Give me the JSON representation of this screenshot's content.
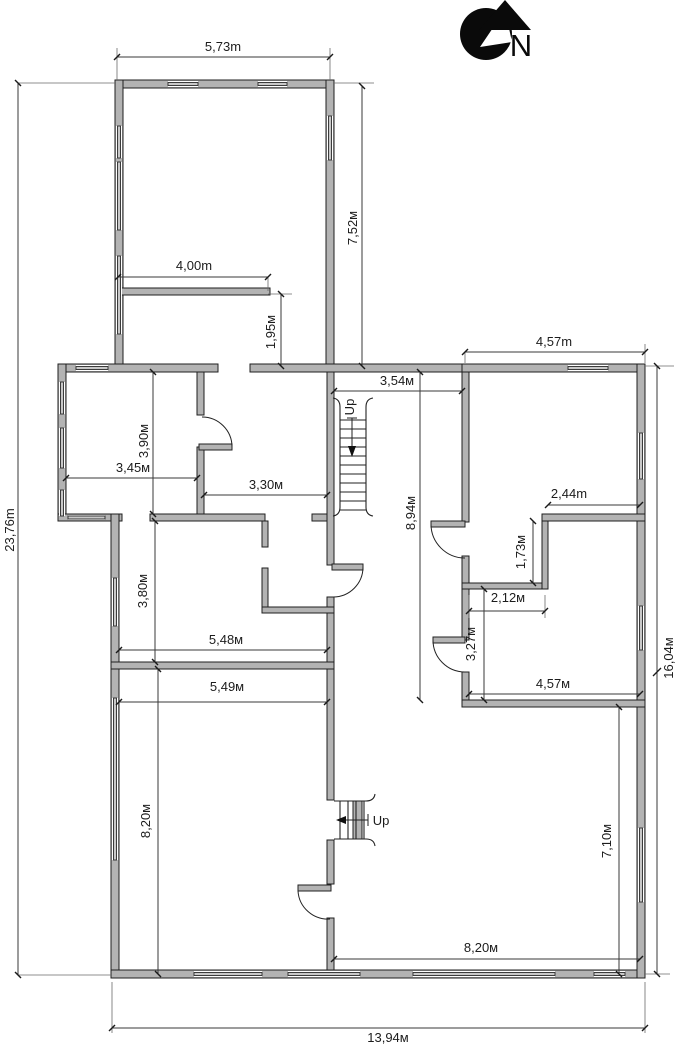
{
  "north": {
    "label": "N"
  },
  "stairs": {
    "upper_label": "Up",
    "lower_label": "Up"
  },
  "dims": {
    "top_width": "5,73m",
    "tower_height": "7,52м",
    "total_height": "23,76m",
    "wall_400": "4,00m",
    "opening_195": "1,95м",
    "corridor_width": "3,54м",
    "right_top_width": "4,57m",
    "room_390": "3,90м",
    "room_345": "3,45м",
    "room_330": "3,30м",
    "hall_894": "8,94м",
    "nook_244": "2,44m",
    "nook_173": "1,73м",
    "nook_212": "2,12м",
    "room_380": "3,80м",
    "width_548": "5,48м",
    "width_549": "5,49м",
    "nook_327": "3,27м",
    "mid_457": "4,57м",
    "right_height": "16,04м",
    "room_820_left": "8,20м",
    "room_710": "7,10м",
    "bottom_820": "8,20м",
    "total_width": "13,94м"
  },
  "colors": {
    "wall_fill": "#b3b3b3",
    "wall_stroke": "#1f1f1f",
    "dimension_line": "#3a3a3a",
    "label_text": "#1c1c1c",
    "north_symbol": "#0a0a0a"
  }
}
